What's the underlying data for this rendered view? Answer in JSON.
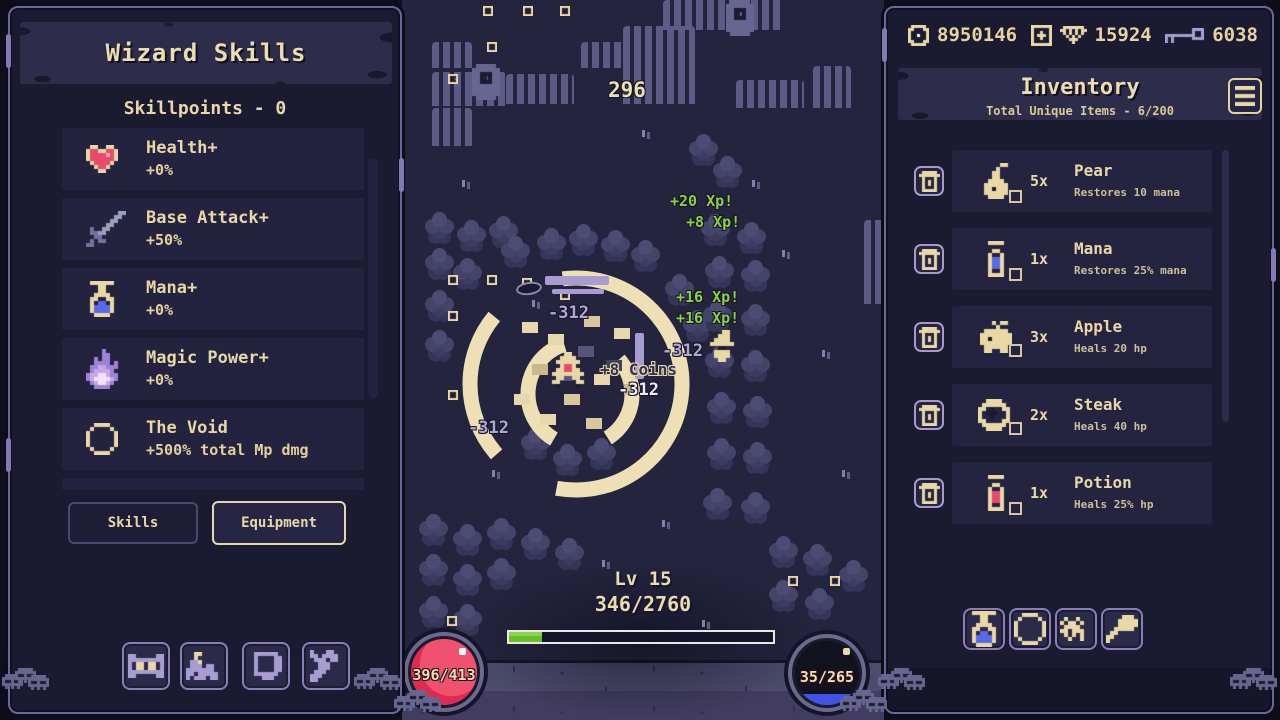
{
  "left_panel": {
    "title": "Wizard Skills",
    "skillpoints": "Skillpoints - 0",
    "skills": [
      {
        "icon": "heart",
        "name": "Health+",
        "value": "+0%"
      },
      {
        "icon": "sword",
        "name": "Base Attack+",
        "value": "+50%"
      },
      {
        "icon": "potion-blue",
        "name": "Mana+",
        "value": "+0%"
      },
      {
        "icon": "fire",
        "name": "Magic Power+",
        "value": "+0%"
      },
      {
        "icon": "void-ring",
        "name": "The Void",
        "value": "+500% total Mp dmg"
      }
    ],
    "tabs": {
      "skills": "Skills",
      "equipment": "Equipment"
    },
    "bottom_buttons": [
      {
        "icon": "crafting"
      },
      {
        "icon": "base"
      },
      {
        "icon": "journal"
      },
      {
        "icon": "wrench"
      }
    ]
  },
  "game": {
    "top_damage": "296",
    "xp_popups": [
      "+20 Xp!",
      "+8 Xp!",
      "+16 Xp!",
      "+16 Xp!"
    ],
    "damage_popups": [
      "-312",
      "-312",
      "-312",
      "-312"
    ],
    "coin_popup": "+8 Coins",
    "level": "Lv 15",
    "xp_progress": "346/2760",
    "health": "396/413",
    "mana": "35/265"
  },
  "right_panel": {
    "currencies": {
      "coins_icon": "coin",
      "coins": "8950146",
      "plus_icon": "plus-box",
      "gems_icon": "gem",
      "gems": "15924",
      "keys_icon": "key",
      "keys": "6038"
    },
    "inventory": {
      "title": "Inventory",
      "subtitle": "Total Unique Items - 6/200"
    },
    "trash_icon": "trash",
    "menu_icon": "menu-lines",
    "items": [
      {
        "icon": "pear",
        "count": "5x",
        "name": "Pear",
        "desc": "Restores 10 mana"
      },
      {
        "icon": "mana-vial",
        "count": "1x",
        "name": "Mana",
        "desc": "Restores 25% mana"
      },
      {
        "icon": "apple",
        "count": "3x",
        "name": "Apple",
        "desc": "Heals 20 hp"
      },
      {
        "icon": "steak",
        "count": "2x",
        "name": "Steak",
        "desc": "Heals 40 hp"
      },
      {
        "icon": "potion-red",
        "count": "1x",
        "name": "Potion",
        "desc": "Heals 25% hp"
      }
    ],
    "bottom_buttons": [
      {
        "icon": "potion-blue"
      },
      {
        "icon": "ring"
      },
      {
        "icon": "pet"
      },
      {
        "icon": "staff"
      }
    ]
  },
  "colors": {
    "accent_cream": "#e9d7a6",
    "xp_green": "#8ad33c",
    "health_red": "#e8395e",
    "mana_blue": "#4a5ce0",
    "panel_border": "#7b6fa6",
    "panel_bg": "#1a1a31",
    "game_bg": "#24243e"
  }
}
